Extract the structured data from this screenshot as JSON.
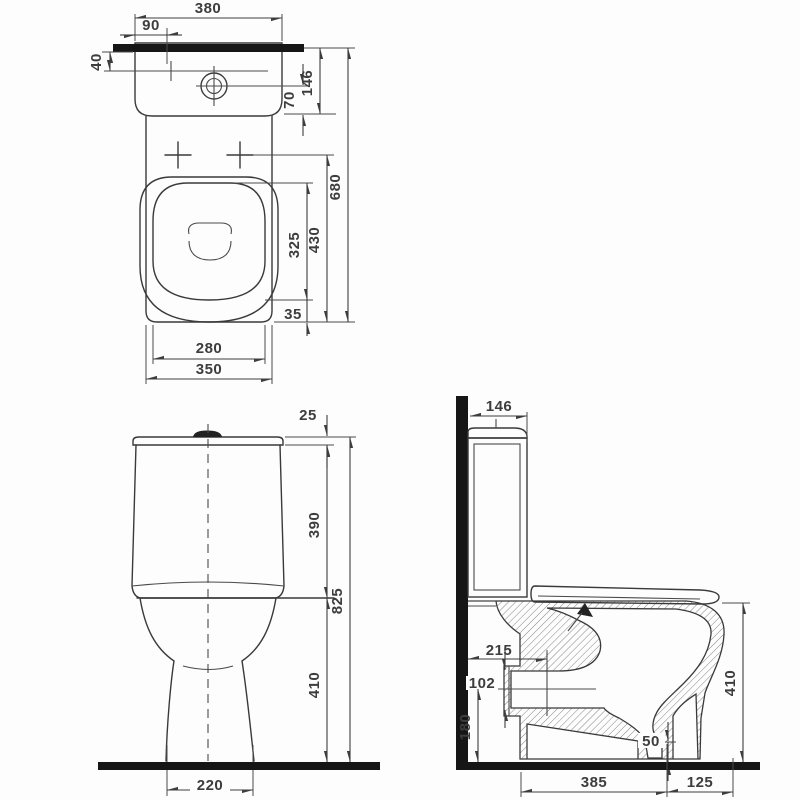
{
  "drawing": {
    "type": "toilet-installation-technical-drawing",
    "line_color": "#3a3a3a",
    "bar_color": "#161616",
    "views": {
      "plan": {
        "dims": {
          "tank_width": "380",
          "hole_offset": "90",
          "wall_to_hole": "40",
          "button_to_front": "70",
          "tank_depth": "146",
          "total_depth": "680",
          "seat_length": "430",
          "opening_length": "325",
          "front_rim": "35",
          "opening_width": "280",
          "bowl_width": "350"
        }
      },
      "front": {
        "dims": {
          "lid_height": "25",
          "tank_height": "390",
          "total_height": "825",
          "bowl_height": "410",
          "base_width": "220"
        }
      },
      "side": {
        "dims": {
          "tank_depth": "146",
          "outlet_length": "215",
          "outlet_bore": "102",
          "outlet_axis_height": "180",
          "outlet_lip": "50",
          "bowl_height": "410",
          "floor_depth": "385",
          "front_overhang": "125"
        }
      }
    }
  }
}
